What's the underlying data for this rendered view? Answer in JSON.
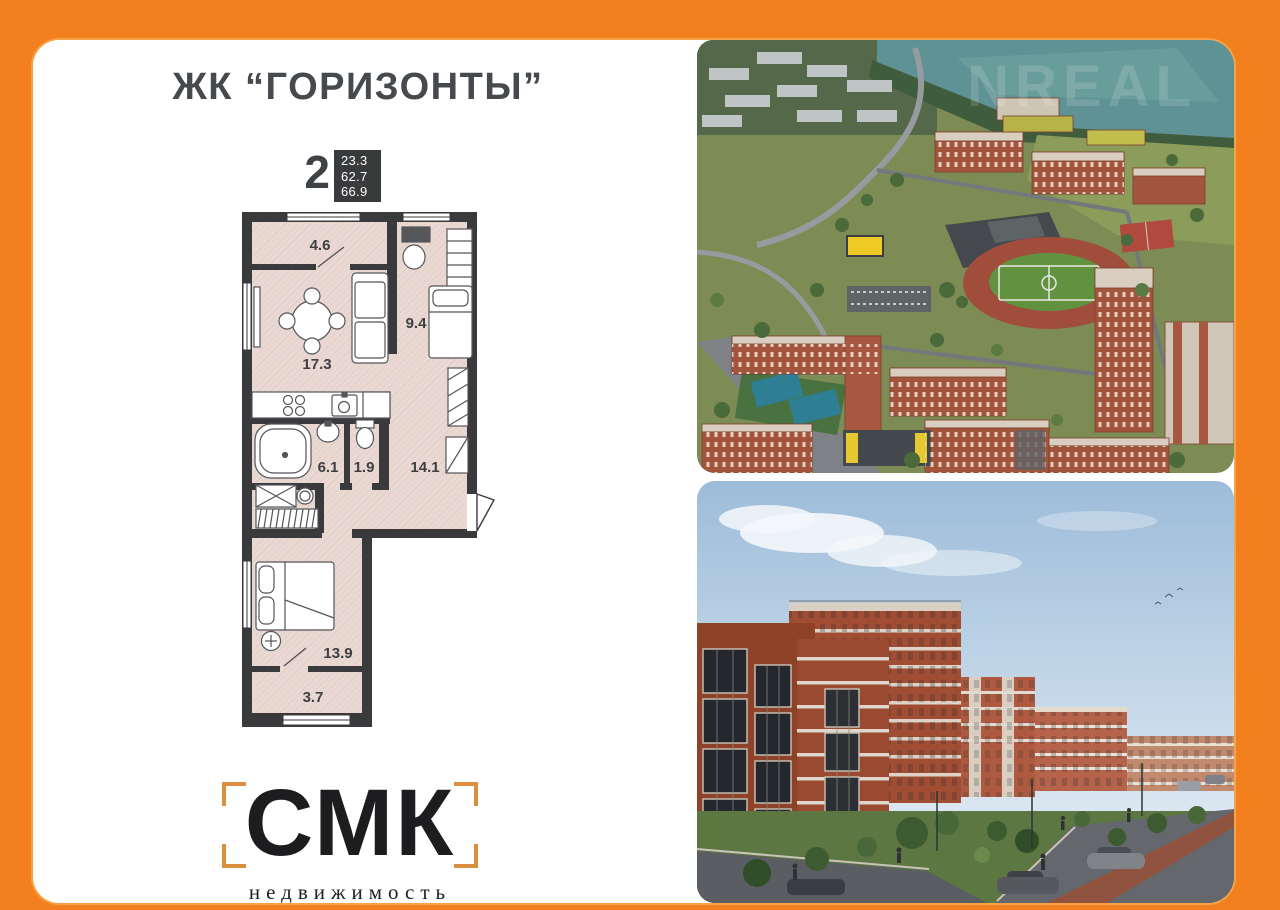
{
  "frame": {
    "background_color": "#F2801E"
  },
  "header": {
    "title": "ЖК “ГОРИЗОНТЫ”"
  },
  "listing": {
    "rooms_count": "2",
    "areas": [
      "23.3",
      "62.7",
      "66.9"
    ]
  },
  "floor_plan": {
    "rooms": [
      {
        "id": "balcony-top",
        "area": "4.6"
      },
      {
        "id": "living-room",
        "area": "17.3"
      },
      {
        "id": "bedroom-top",
        "area": "9.4"
      },
      {
        "id": "bathroom",
        "area": "6.1"
      },
      {
        "id": "wc",
        "area": "1.9"
      },
      {
        "id": "hallway",
        "area": "14.1"
      },
      {
        "id": "bedroom-bottom",
        "area": "13.9"
      },
      {
        "id": "balcony-bottom",
        "area": "3.7"
      }
    ],
    "colors": {
      "walls": "#3A3A3C",
      "floor": "#EAD9D3"
    }
  },
  "logo": {
    "name": "СМК",
    "subtitle": "недвижимость",
    "bracket_color": "#D98F3E"
  },
  "photos": {
    "watermark": "NREAL"
  }
}
